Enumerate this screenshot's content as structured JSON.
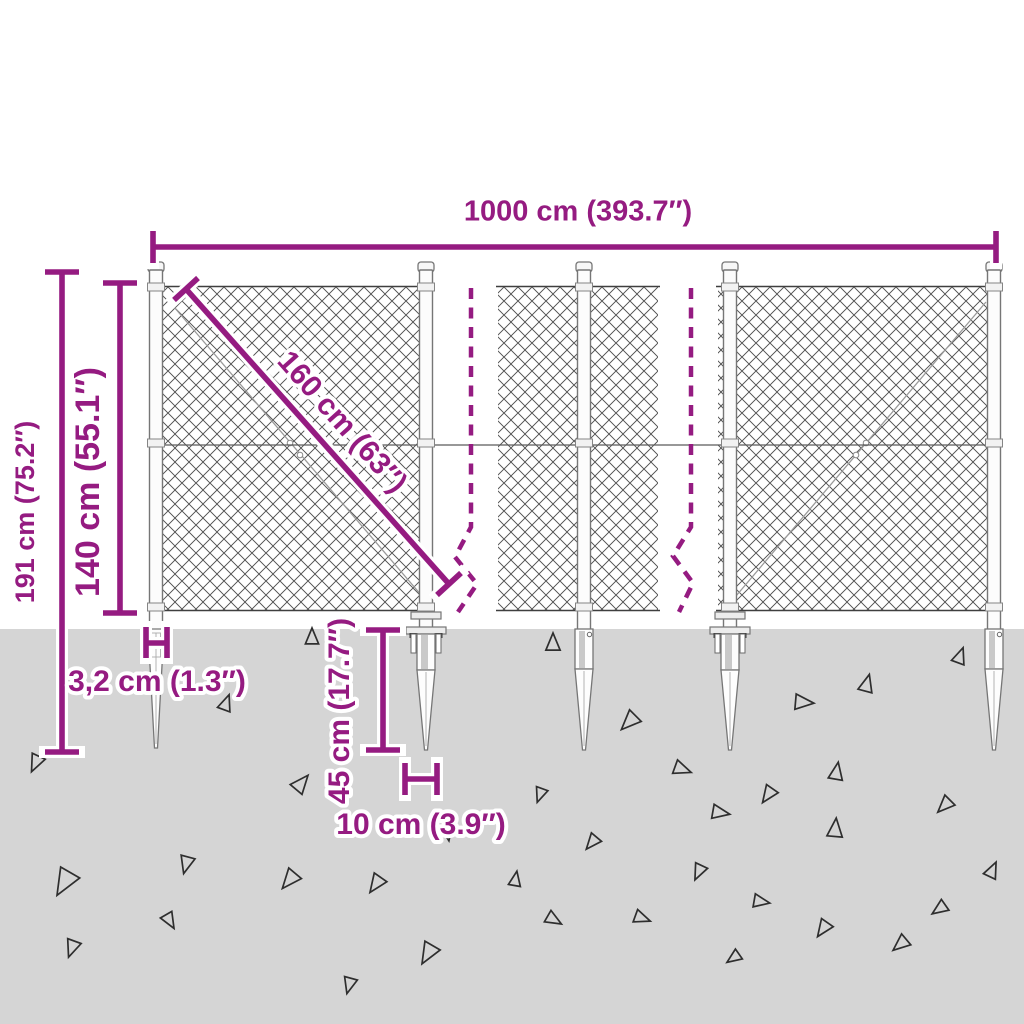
{
  "image": {
    "description": "Dimension diagram of a chain-link fence with pointed spike ground anchors"
  },
  "colors": {
    "dimension_accent": "#951b81",
    "ground": "#d5d5d5",
    "mesh_line": "#4f4f4f",
    "background": "#ffffff"
  },
  "labels": {
    "total_width": "1000 cm (393.7″)",
    "total_height": "191 cm (75.2″)",
    "fence_height": "140 cm (55.1″)",
    "diagonal": "160 cm (63″)",
    "post_width": "3,2 cm (1.3″)",
    "anchor_length": "45 cm (17.7″)",
    "anchor_width": "10 cm (3.9″)"
  },
  "ground": {
    "triangles": [
      [
        37,
        760,
        13,
        205
      ],
      [
        225,
        706,
        12,
        20
      ],
      [
        312,
        640,
        12,
        0
      ],
      [
        299,
        786,
        14,
        40
      ],
      [
        67,
        878,
        20,
        210
      ],
      [
        187,
        861,
        13,
        195
      ],
      [
        168,
        918,
        12,
        150
      ],
      [
        73,
        945,
        13,
        200
      ],
      [
        292,
        877,
        15,
        220
      ],
      [
        378,
        881,
        14,
        215
      ],
      [
        430,
        950,
        16,
        210
      ],
      [
        447,
        830,
        11,
        170
      ],
      [
        350,
        982,
        12,
        195
      ],
      [
        553,
        646,
        13,
        0
      ],
      [
        632,
        719,
        15,
        225
      ],
      [
        679,
        768,
        13,
        110
      ],
      [
        541,
        792,
        11,
        200
      ],
      [
        717,
        812,
        13,
        100
      ],
      [
        770,
        792,
        13,
        215
      ],
      [
        800,
        702,
        14,
        95
      ],
      [
        836,
        775,
        13,
        10
      ],
      [
        866,
        687,
        13,
        15
      ],
      [
        959,
        659,
        12,
        20
      ],
      [
        947,
        803,
        13,
        225
      ],
      [
        594,
        840,
        12,
        220
      ],
      [
        700,
        869,
        12,
        205
      ],
      [
        515,
        882,
        11,
        10
      ],
      [
        551,
        918,
        12,
        120
      ],
      [
        639,
        917,
        12,
        110
      ],
      [
        758,
        901,
        12,
        100
      ],
      [
        825,
        926,
        13,
        215
      ],
      [
        835,
        832,
        14,
        5
      ],
      [
        903,
        942,
        13,
        230
      ],
      [
        942,
        907,
        12,
        235
      ],
      [
        991,
        873,
        12,
        25
      ],
      [
        736,
        956,
        11,
        235
      ]
    ]
  }
}
